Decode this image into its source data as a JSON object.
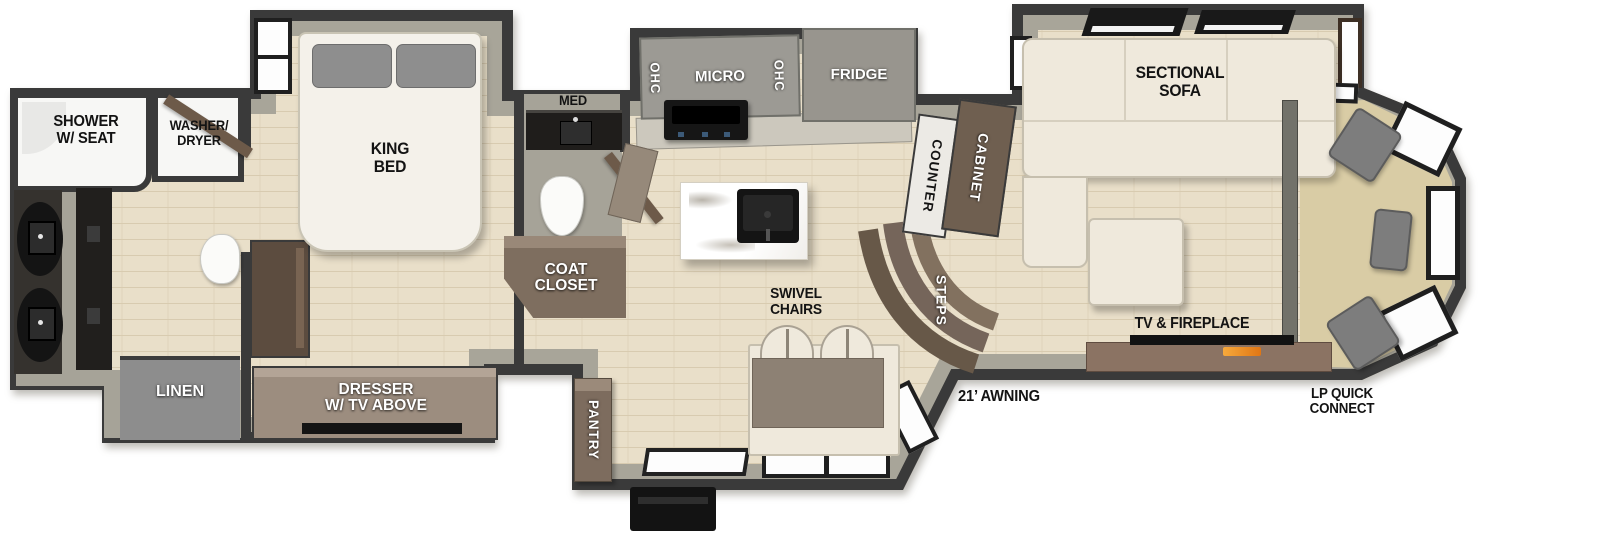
{
  "diagram": {
    "kind": "RV fifth-wheel floor plan",
    "labels": {
      "shower": "SHOWER\nW/ SEAT",
      "washer_dryer": "WASHER/\nDRYER",
      "linen": "LINEN",
      "king_bed": "KING\nBED",
      "dresser": "DRESSER\nW/ TV ABOVE",
      "med": "MED",
      "coat_closet": "COAT\nCLOSET",
      "ohc_left": "OHC",
      "micro": "MICRO",
      "ohc_right": "OHC",
      "fridge": "FRIDGE",
      "counter": "COUNTER",
      "cabinet": "CABINET",
      "steps": "STEPS",
      "pantry": "PANTRY",
      "swivel_chairs": "SWIVEL\nCHAIRS",
      "sectional_sofa": "SECTIONAL\nSOFA",
      "tv_fireplace": "TV & FIREPLACE",
      "awning": "21’ AWNING",
      "lp_quick_connect": "LP QUICK\nCONNECT"
    },
    "colors": {
      "wall": "#3a3a3a",
      "wall_band": "#a8a599",
      "wood_floor": "#e9dfc9",
      "bath_floor": "#a6a398",
      "cap_floor": "#d9cca5",
      "cabinet_gray": "#9c9a94",
      "cabinet_brown": "#7d6c5c",
      "dresser_brown": "#9c8d7f",
      "sofa_cream": "#efe9dc",
      "table_taupe": "#8d8174",
      "linen_gray": "#8d8d8d",
      "seat_gray": "#7d7d7d",
      "fireplace_flame": "#f08c1e"
    }
  }
}
